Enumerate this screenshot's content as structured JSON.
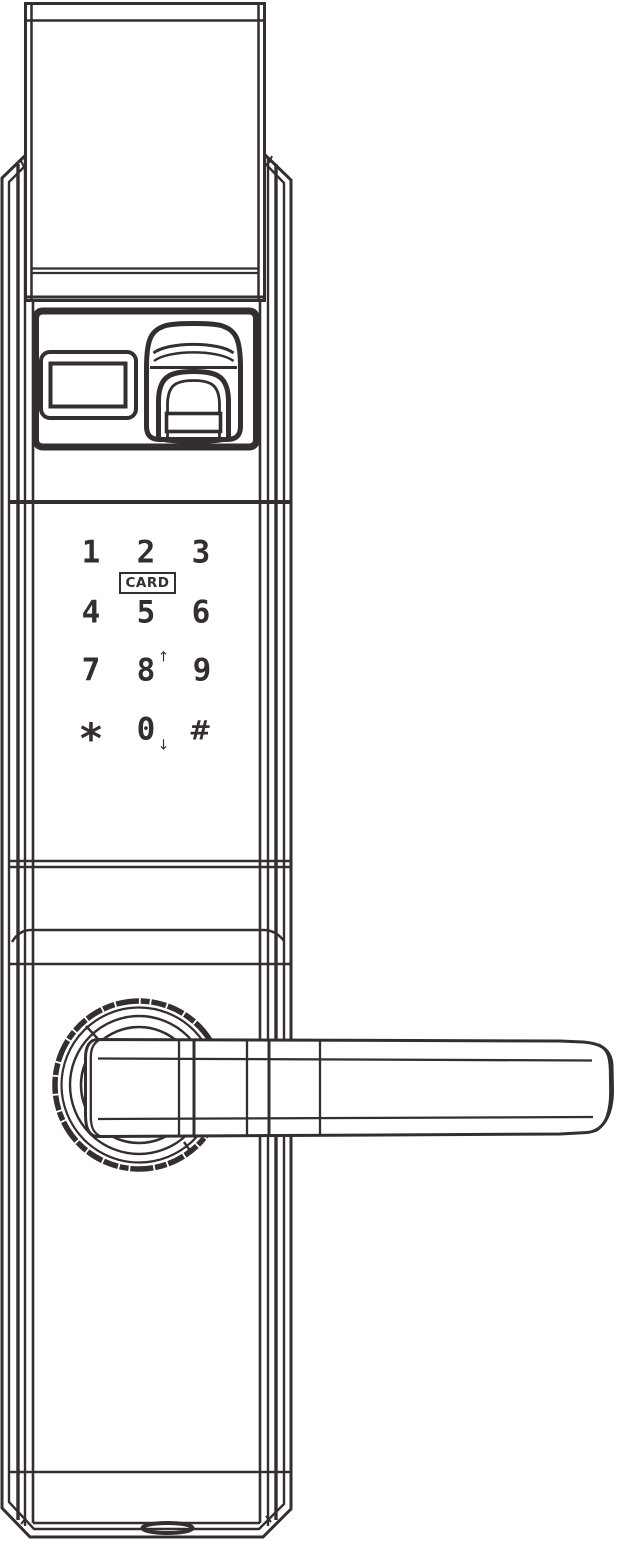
{
  "colors": {
    "line": "#352e2e",
    "background": "#ffffff"
  },
  "keypad": {
    "keys": [
      {
        "label": "1"
      },
      {
        "label": "2"
      },
      {
        "label": "3"
      },
      {
        "label": "4"
      },
      {
        "label": "5"
      },
      {
        "label": "6"
      },
      {
        "label": "7"
      },
      {
        "label": "8",
        "arrow": "↑"
      },
      {
        "label": "9"
      },
      {
        "label": "*"
      },
      {
        "label": "0",
        "arrow": "↓"
      },
      {
        "label": "#"
      }
    ],
    "card_label": "CARD"
  }
}
